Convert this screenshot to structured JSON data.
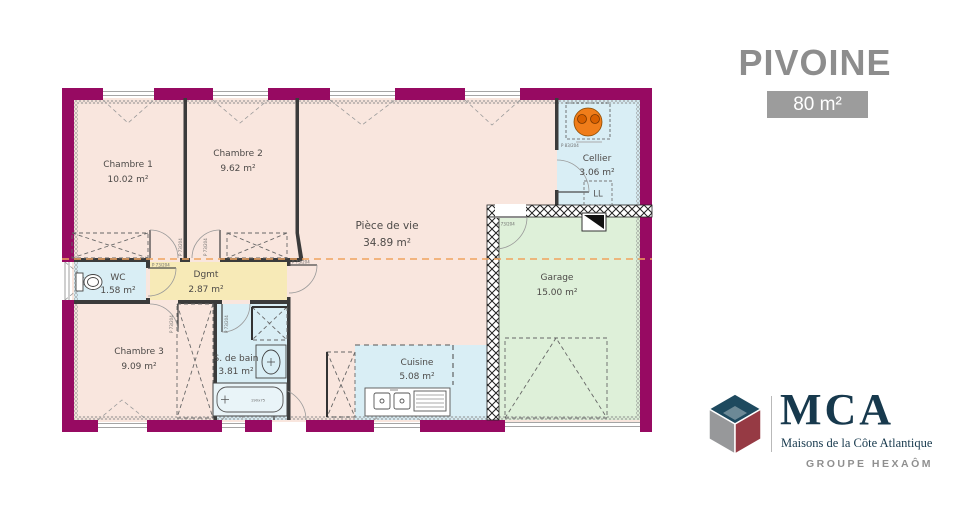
{
  "header": {
    "title": "PIVOINE",
    "area_badge": "80 m²"
  },
  "plan": {
    "rooms": [
      {
        "name": "Chambre 1",
        "area": "10.02 m²"
      },
      {
        "name": "Chambre 2",
        "area": "9.62 m²"
      },
      {
        "name": "Pièce de vie",
        "area": "34.89 m²"
      },
      {
        "name": "Cellier",
        "area": "3.06 m²"
      },
      {
        "name": "Garage",
        "area": "15.00 m²"
      },
      {
        "name": "WC",
        "area": "1.58 m²"
      },
      {
        "name": "Dgmt",
        "area": "2.87 m²"
      },
      {
        "name": "Chambre 3",
        "area": "9.09 m²"
      },
      {
        "name": "S. de bain",
        "area": "3.81 m²"
      },
      {
        "name": "Cuisine",
        "area": "5.08 m²"
      }
    ],
    "labels": {
      "washing_machine": "LL",
      "bathtub_size": "190x75"
    },
    "door_labels": {
      "standard": "P 73/204",
      "cellier": "P 83/204"
    },
    "colors": {
      "exterior_wall": "#970a62",
      "room_pink": "#f9e6de",
      "room_blue": "#d9eef5",
      "room_yellow": "#f7eab7",
      "room_green": "#def0d9",
      "section_line": "#f0a35e",
      "water_heater": "#f07d1a"
    }
  },
  "branding": {
    "name": "MCA",
    "tagline": "Maisons de la Côte Atlantique",
    "group": "GROUPE HEXAÔM"
  }
}
